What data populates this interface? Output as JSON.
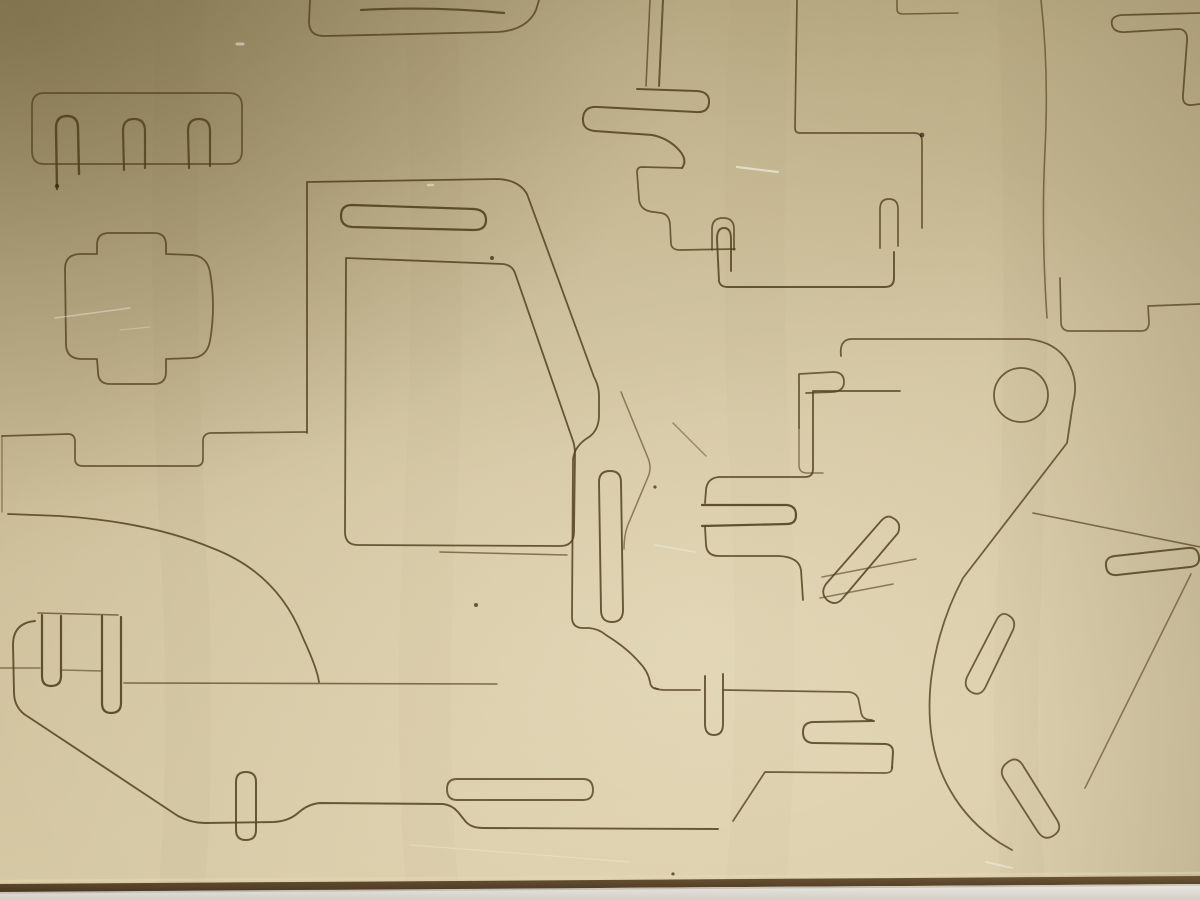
{
  "scene": {
    "subject": "laser-cut plywood sheet with punch-out toy vehicle parts, photographed from above; bottom edge of sheet rests on a light table",
    "colors": {
      "wood_dark": "#9d8f66",
      "wood_mid": "#bcae87",
      "wood_light": "#cfc19c",
      "wood_lightest": "#d7caa6",
      "sheen": "#fff7e0",
      "cut": "#54411f",
      "burn": "#2f2310",
      "edge_dark": "#4a3824",
      "edge_brown": "#6b5434",
      "bevel": "#e6d9b4",
      "table_light": "#eceae3",
      "table_dark": "#cfcdc5",
      "scratch": "#ffffff"
    }
  },
  "cut_lines": {
    "stroke": "#54411f",
    "paths": [
      {
        "d": "M44,93 H229 Q242,93 242,106 V151 Q242,164 229,164 H44 Q32,164 32,151 V106 Q32,93 44,93 Z",
        "w": 1.8,
        "o": 0.75
      },
      {
        "d": "M57,189 L56,128 Q56,116 67,116 Q78,116 78,128 L79,174",
        "w": 2.4,
        "o": 0.9
      },
      {
        "d": "M124,170 L123,131 Q123,119 134,119 Q145,119 145,131 L145,168",
        "w": 2.2,
        "o": 0.85
      },
      {
        "d": "M189,168 L188,131 Q188,119 199,119 Q210,119 210,131 L210,166",
        "w": 2.2,
        "o": 0.85
      },
      {
        "d": "M97,254 L97,245 Q97,233 109,233 L154,233 Q166,233 166,245 L166,254 L192,255 Q207,256 210,272 Q216,306 210,341 Q207,357 192,358 L166,359 L166,372 Q166,384 154,384 L110,384 Q98,384 98,372 L97,359 L82,359 Q66,359 66,344 L65,269 Q65,254 81,254 Z",
        "w": 1.8,
        "o": 0.8
      },
      {
        "d": "M310,0 L309,22 Q309,36 324,36 L498,32 Q527,30 536,10 L539,0",
        "w": 1.8,
        "o": 0.8
      },
      {
        "d": "M361,10 Q433,6 504,13",
        "w": 2.2,
        "o": 0.85
      },
      {
        "d": "M650,0 L646,86",
        "w": 1.6,
        "o": 0.7
      },
      {
        "d": "M663,0 L659,86",
        "w": 2,
        "o": 0.8
      },
      {
        "d": "M637,89 L697,91 Q710,92 709,103 Q708,113 696,112 L598,107 Q584,106 583,118 Q582,130 595,131 L652,135 Q668,138 679,150 Q688,160 682,168",
        "w": 2,
        "o": 0.85
      },
      {
        "d": "M682,168 L642,167 Q637,167 637,172 L639,199 Q640,211 654,212 L661,213 Q669,214 670,224 L671,244 Q672,250 680,250 L735,249",
        "w": 1.7,
        "o": 0.8
      },
      {
        "d": "M712,250 L712,229 Q712,218 723,218 Q734,218 734,229 L734,250",
        "w": 1.7,
        "o": 0.8
      },
      {
        "d": "M797,0 L795,128 Q795,133 800,133 L914,133 Q922,133 922,141 L922,228",
        "w": 1.7,
        "o": 0.8
      },
      {
        "d": "M880,248 L880,209 Q880,199 889,199 Q898,199 898,209 L898,246",
        "w": 1.7,
        "o": 0.8
      },
      {
        "d": "M731,271 L731,239 Q731,228 724,228 Q717,228 717,239 L719,281 Q720,287 728,287 L885,287 Q894,287 894,278 L894,252",
        "w": 1.9,
        "o": 0.85
      },
      {
        "d": "M897,0 L897,9 Q897,14 903,14 L958,13",
        "w": 1.6,
        "o": 0.7
      },
      {
        "d": "M1041,0 Q1049,70 1045,150 Q1041,230 1047,318",
        "w": 1.6,
        "o": 0.65
      },
      {
        "d": "M1200,13 L1122,15 Q1110,16 1112,25 Q1114,33 1126,32 L1178,29 Q1188,29 1187,41 L1183,95 Q1182,106 1192,105 L1200,104",
        "w": 1.8,
        "o": 0.8
      },
      {
        "d": "M1060,278 L1061,322 Q1061,331 1070,331 L1141,331 Q1149,331 1149,322 L1148,306 L1200,304",
        "w": 1.7,
        "o": 0.75
      },
      {
        "d": "M900,391 L813,391 L813,469 Q813,477 805,477 L719,477 Q707,478 706,490 L705,503",
        "w": 1.8,
        "o": 0.85
      },
      {
        "d": "M702,505 L787,505 Q796,506 796,515 Q796,524 787,524 L702,526",
        "w": 2.2,
        "o": 0.9
      },
      {
        "d": "M705,527 L706,545 Q707,556 719,556 L779,556 Q799,557 801,570 L803,600",
        "w": 1.8,
        "o": 0.85
      },
      {
        "d": "M841,356 Q839,339 852,339 L1028,339 Q1056,342 1068,362 Q1079,381 1073,403 L1067,443 L963,578 Q938,625 931,680 Q924,745 950,790 Q968,822 1000,843 L1012,850",
        "w": 1.8,
        "o": 0.8
      },
      {
        "d": "M994,395 A27,27 0 1 0 1048,395 A27,27 0 1 0 994,395 Z",
        "w": 1.8,
        "o": 0.8
      },
      {
        "d": "M799,428 L799,374 L833,372 Q844,372 844,382 Q844,391 833,392 L806,393",
        "w": 1.8,
        "o": 0.8
      },
      {
        "d": "M799,428 L799,465 Q799,473 807,473 L823,473",
        "w": 1.5,
        "o": 0.6
      },
      {
        "d": "M893,518 Q902,523 898,533 L843,598 Q836,607 827,600 Q820,593 826,584 L881,521 Q887,514 893,518 Z",
        "w": 1.8,
        "o": 0.85
      },
      {
        "d": "M822,577 L916,559",
        "w": 1.6,
        "o": 0.6
      },
      {
        "d": "M820,598 L893,584",
        "w": 1.6,
        "o": 0.6
      },
      {
        "d": "M1033,513 L1200,547",
        "w": 1.6,
        "o": 0.7
      },
      {
        "d": "M1115,556 L1188,548 Q1198,547 1199,557 Q1200,566 1190,567 L1117,575 Q1107,576 1106,566 Q1105,557 1115,556 Z",
        "w": 2,
        "o": 0.85
      },
      {
        "d": "M1191,574 L1085,788",
        "w": 1.6,
        "o": 0.6
      },
      {
        "d": "M1008,762 Q1016,756 1022,764 L1057,820 Q1063,830 1053,836 Q1044,841 1038,832 L1004,779 Q998,769 1008,762 Z",
        "w": 1.8,
        "o": 0.8
      },
      {
        "d": "M1008,615 Q1017,620 1013,630 L985,688 Q980,697 971,692 Q963,687 967,677 L996,621 Q1001,611 1008,615 Z",
        "w": 1.8,
        "o": 0.8
      },
      {
        "d": "M35,621 Q13,623 13,645 L14,692 Q14,706 24,714 L178,816 Q191,823 205,823 L274,822 Q289,821 298,813 Q308,804 320,803 L443,804 Q452,805 458,812 L466,822 Q472,828 482,828 L718,829",
        "w": 1.9,
        "o": 0.85
      },
      {
        "d": "M655,688 Q658,690 666,690 L700,690 M724,690 L849,692 Q858,693 859,702 L861,712 Q862,720 872,720",
        "w": 1.7,
        "o": 0.8
      },
      {
        "d": "M874,721 L814,722 Q803,722 803,732 Q803,743 814,743 L886,744 Q893,745 893,752 L892,768",
        "w": 2,
        "o": 0.85
      },
      {
        "d": "M892,768 Q892,773 885,773 L765,772 L733,821",
        "w": 1.7,
        "o": 0.8
      },
      {
        "d": "M705,676 L705,724 Q705,735 714,735 Q723,735 723,724 L723,674",
        "w": 1.9,
        "o": 0.85
      },
      {
        "d": "M307,433 L307,182 L498,179 Q519,180 527,194 L594,377 Q599,386 599,396 L599,415 Q599,430 589,437 Q574,446 573,460 L572,617 Q572,628 583,628 L589,628 Q599,629 606,635 Q627,648 639,662 Q648,671 650,682 Q651,689 658,689",
        "w": 1.8,
        "o": 0.85
      },
      {
        "d": "M599,482 Q599,471 610,471 Q621,471 621,482 L623,610 Q623,622 612,622 Q601,622 601,610 Z",
        "w": 1.9,
        "o": 0.85
      },
      {
        "d": "M346,258 L503,264 Q512,265 515,273 L572,438 Q575,445 575,455 L574,532 Q574,546 560,546 L358,545 Q345,545 345,532 Z",
        "w": 1.8,
        "o": 0.85
      },
      {
        "d": "M352,205 L474,209 Q486,210 486,220 Q486,230 474,230 L352,227 Q341,226 341,216 Q341,205 352,205 Z",
        "w": 2.2,
        "o": 0.9
      },
      {
        "d": "M236,782 Q236,772 246,772 Q256,772 256,782 L256,830 Q256,840 246,840 Q236,840 236,830 Z",
        "w": 2,
        "o": 0.85
      },
      {
        "d": "M457,779 L583,779 Q593,779 593,790 Q593,800 583,800 L457,800 Q447,800 447,789 Q447,779 457,779 Z",
        "w": 1.9,
        "o": 0.8
      },
      {
        "d": "M38,613 L118,615",
        "w": 1.6,
        "o": 0.7
      },
      {
        "d": "M42,615 L42,676 Q42,686 51,686 Q61,686 61,676 L61,616",
        "w": 2.2,
        "o": 0.9
      },
      {
        "d": "M102,616 L102,703 Q102,713 111,713 Q121,713 121,703 L121,617",
        "w": 2.2,
        "o": 0.9
      },
      {
        "d": "M0,668 L40,668 M62,670 L101,671",
        "w": 1.5,
        "o": 0.6
      },
      {
        "d": "M124,683 L497,684",
        "w": 1.6,
        "o": 0.7
      },
      {
        "d": "M2,436 L68,434 Q75,434 75,442 L75,459 Q75,466 83,466 L196,466 Q203,466 203,459 L203,441 Q203,434 210,433 L306,432",
        "w": 1.7,
        "o": 0.8
      },
      {
        "d": "M2,436 L2,512",
        "w": 1.4,
        "o": 0.5
      },
      {
        "d": "M8,514 L60,516 Q150,522 212,548 Q278,573 303,638 Q317,668 319,682",
        "w": 1.8,
        "o": 0.85
      },
      {
        "d": "M621,392 L648,458 Q652,468 648,477 L630,520 Q624,532 624,549",
        "w": 1.5,
        "o": 0.6
      },
      {
        "d": "M673,423 L706,456",
        "w": 1.4,
        "o": 0.5
      },
      {
        "d": "M440,552 L567,555",
        "w": 1.5,
        "o": 0.65
      }
    ]
  },
  "burn_marks": [
    {
      "x": 492,
      "y": 258,
      "r": 2
    },
    {
      "x": 476,
      "y": 605,
      "r": 2
    },
    {
      "x": 673,
      "y": 874,
      "r": 1.6
    },
    {
      "x": 922,
      "y": 135,
      "r": 2.4
    },
    {
      "x": 57,
      "y": 186,
      "r": 2.2
    },
    {
      "x": 655,
      "y": 487,
      "r": 1.6
    }
  ],
  "scratches": [
    {
      "d": "M55,318 L130,308",
      "w": 1.5,
      "o": 0.35
    },
    {
      "d": "M737,167 L778,172",
      "w": 2.2,
      "o": 0.5
    },
    {
      "d": "M655,545 L695,552",
      "w": 1.6,
      "o": 0.3
    },
    {
      "d": "M410,845 L630,862",
      "w": 1.2,
      "o": 0.22
    },
    {
      "d": "M237,44 L243,44",
      "w": 3,
      "o": 0.45
    },
    {
      "d": "M428,185 L433,185",
      "w": 2.5,
      "o": 0.4
    },
    {
      "d": "M986,862 L1012,868",
      "w": 2,
      "o": 0.35
    },
    {
      "d": "M120,330 L150,327",
      "w": 1.2,
      "o": 0.25
    }
  ],
  "grain_streaks": [
    {
      "d": "M180,0 Q168,300 186,600 Q192,760 182,886",
      "w": 46,
      "o": 0.06
    },
    {
      "d": "M430,0 Q444,280 428,560 Q420,740 432,886",
      "w": 52,
      "o": 0.05
    },
    {
      "d": "M760,0 Q748,260 762,520 Q770,720 756,886",
      "w": 60,
      "o": 0.05
    },
    {
      "d": "M1020,0 Q1032,300 1018,620 Q1012,780 1024,886",
      "w": 44,
      "o": 0.06
    }
  ]
}
